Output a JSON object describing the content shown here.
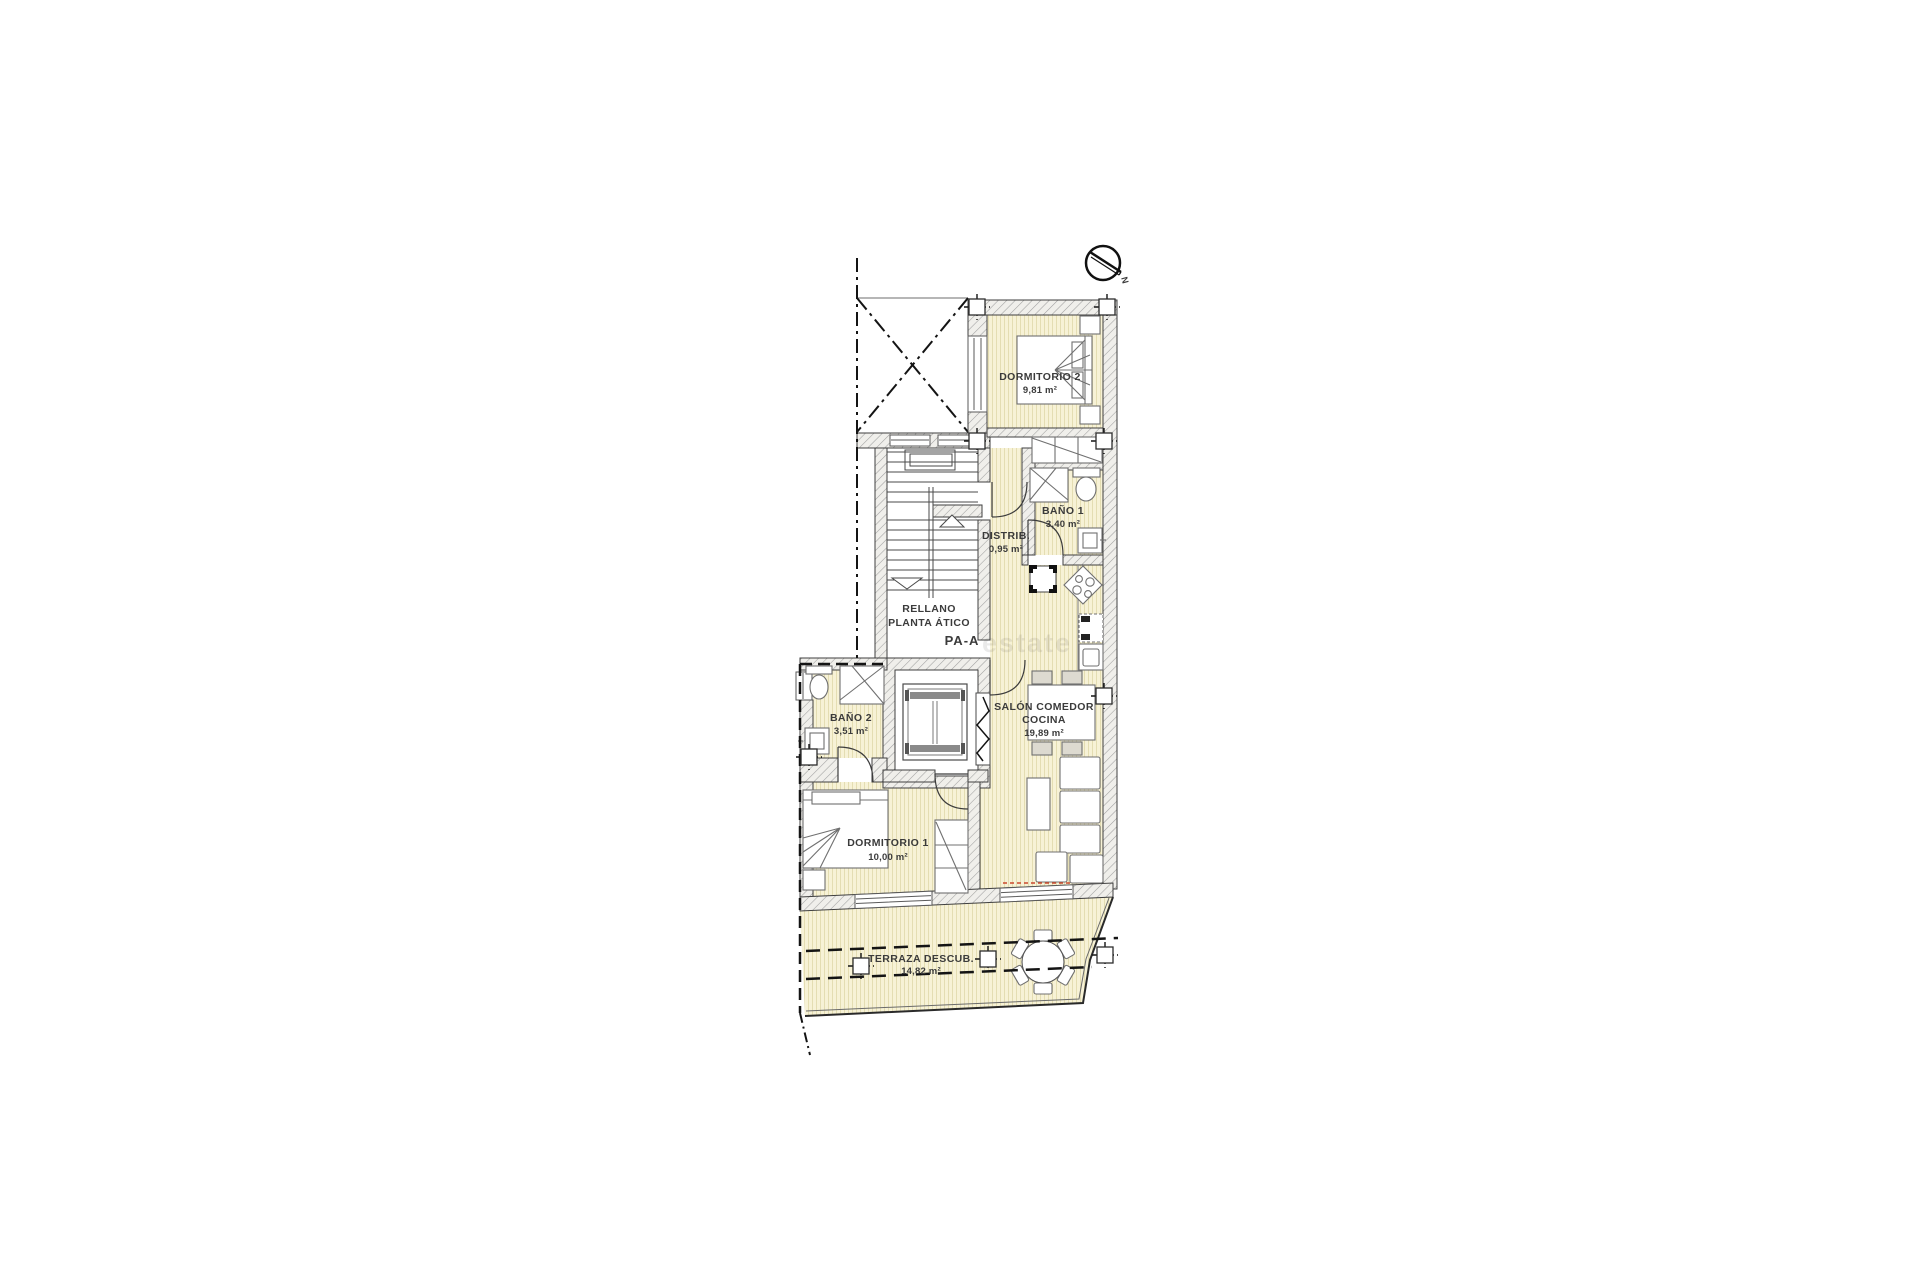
{
  "canvas": {
    "width": 1920,
    "height": 1280,
    "background": "#ffffff"
  },
  "colors": {
    "room_fill": "#f7f2d6",
    "room_stripe": "#e4ddb2",
    "wall_hatch_line": "#a0a0a0",
    "wall_hatch_bg": "#f0efeb",
    "wall_outline": "#3f3f3f",
    "furniture_line": "#707070",
    "boundary_line": "#141414",
    "label_text": "#3b3b3b",
    "unit_code_red": "#e0553f",
    "awning_dash_red": "#cc4a2e"
  },
  "compass": {
    "label": "N"
  },
  "rooms": {
    "dormitorio2": {
      "name": "DORMITORIO 2",
      "area": "9,81 m²"
    },
    "bano1": {
      "name": "BAÑO 1",
      "area": "3,40 m²"
    },
    "distrib": {
      "name": "DISTRIB.",
      "area": "0,95 m²"
    },
    "bano2": {
      "name": "BAÑO 2",
      "area": "3,51 m²"
    },
    "salon": {
      "name_line1": "SALÓN COMEDOR",
      "name_line2": "COCINA",
      "area": "19,89 m²"
    },
    "dormitorio1": {
      "name": "DORMITORIO 1",
      "area": "10,00 m²"
    },
    "terraza": {
      "name": "TERRAZA DESCUB.",
      "area": "14,82 m²"
    }
  },
  "landing": {
    "line1": "RELLANO",
    "line2": "PLANTA ÁTICO",
    "unit_code": "PA-A"
  },
  "watermark": {
    "text": "estate"
  }
}
